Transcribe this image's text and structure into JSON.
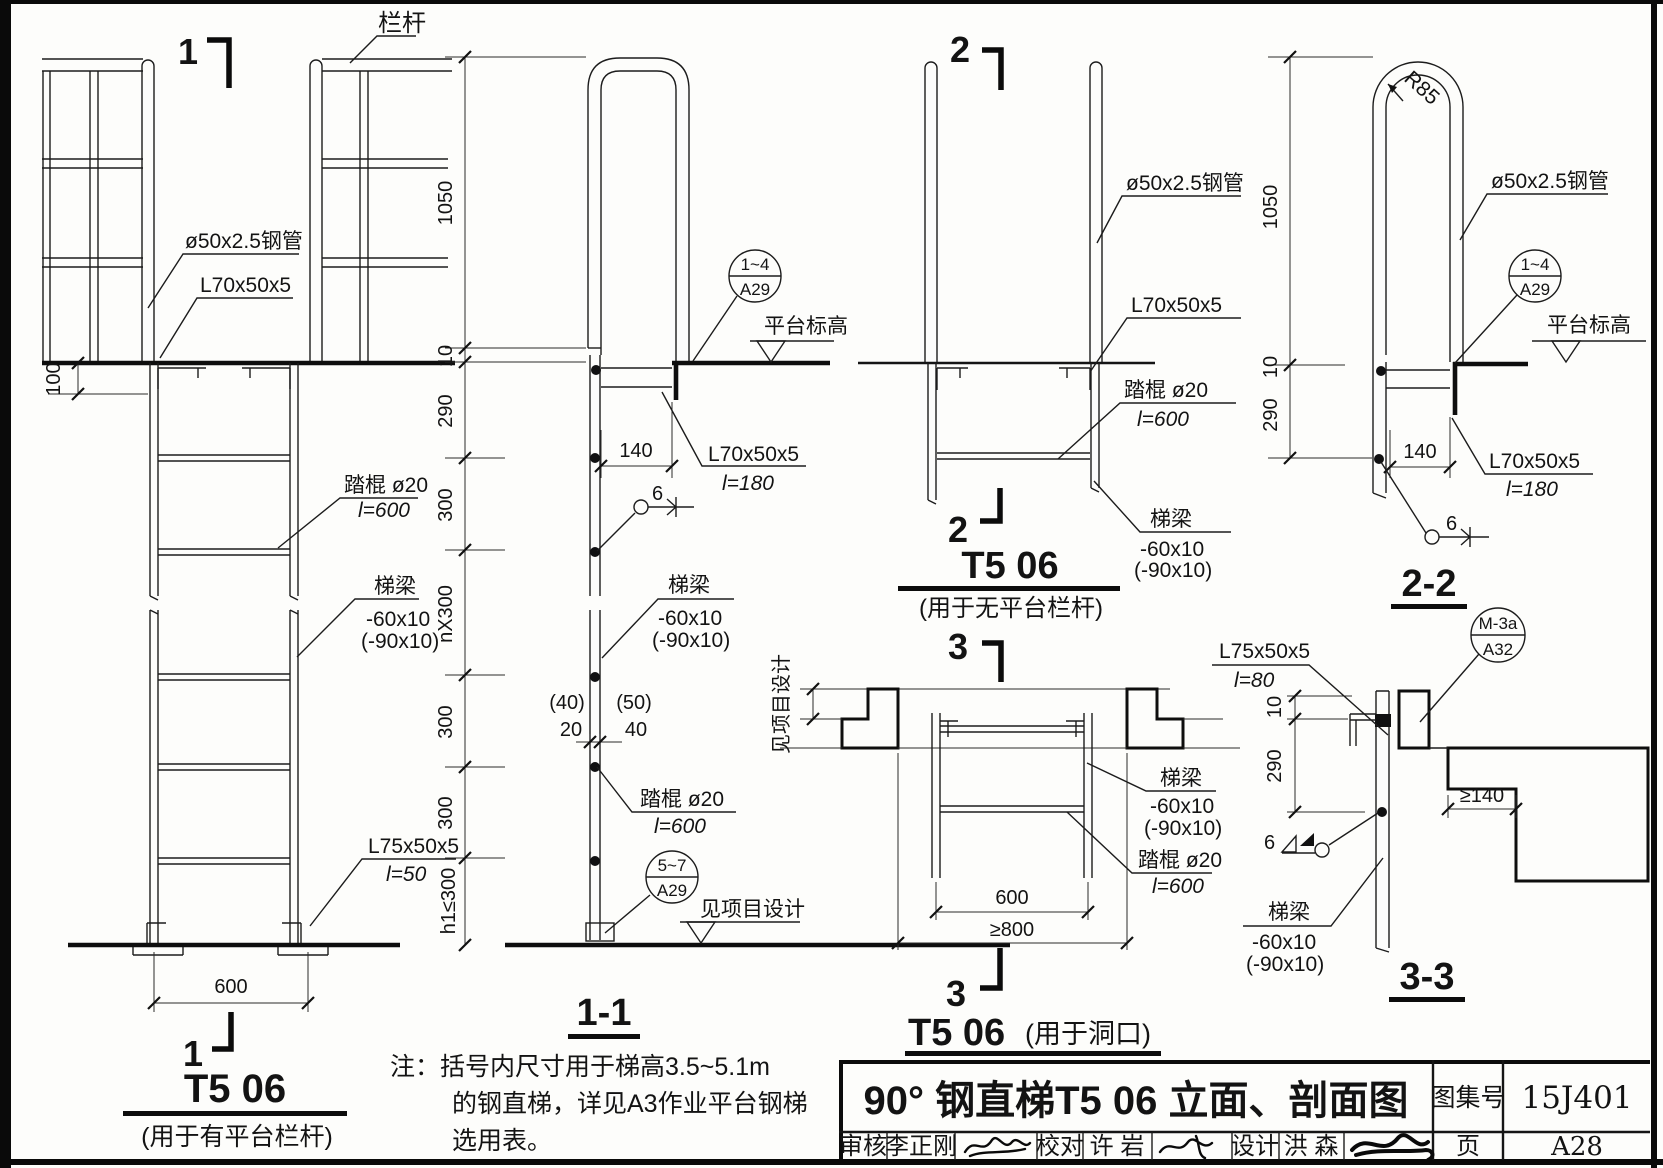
{
  "common": {
    "handrail": "栏杆",
    "pipe": "ø50x2.5钢管",
    "angle70": "L70x50x5",
    "angle70_len": "l=180",
    "rung": "踏棍 ø20",
    "rung_len": "l=600",
    "beam": "梯梁",
    "beam_size": "-60x10",
    "beam_size_alt": "(-90x10)",
    "angle75": "L75x50x5",
    "angle75_len": "l=50",
    "angle75_clip_len": "l=80",
    "platform_level": "平台标高",
    "project_design": "见项目设计",
    "weld_size": "6",
    "radius": "R85"
  },
  "dims": {
    "d100": "100",
    "d600": "600",
    "d1050": "1050",
    "d10": "10",
    "d290": "290",
    "d300a": "300",
    "dn300": "nX300",
    "d300b": "300",
    "d300c": "300",
    "h1": "h1≤300",
    "d140": "140",
    "p40": "(40)",
    "d20": "20",
    "p50": "(50)",
    "d40": "40",
    "ge800": "≥800",
    "ge140": "≥140"
  },
  "callouts": {
    "c14a29": {
      "top": "1~4",
      "bot": "A29"
    },
    "c57a29": {
      "top": "5~7",
      "bot": "A29"
    },
    "cm3a32": {
      "top": "M-3a",
      "bot": "A32"
    }
  },
  "sections": {
    "s1": {
      "marker": "1",
      "title": "T5 06",
      "subtitle": "(用于有平台栏杆)"
    },
    "s11": {
      "title": "1-1"
    },
    "s2": {
      "marker": "2",
      "title": "T5 06",
      "subtitle": "(用于无平台栏杆)"
    },
    "s22": {
      "title": "2-2"
    },
    "s3": {
      "marker": "3",
      "title": "T5 06",
      "subtitle": "(用于洞口)"
    },
    "s33": {
      "title": "3-3"
    }
  },
  "note": {
    "l1": "注：括号内尺寸用于梯高3.5~5.1m",
    "l2": "的钢直梯，详见A3作业平台钢梯",
    "l3": "选用表。"
  },
  "titleblock": {
    "main_title": "90° 钢直梯T5 06 立面、剖面图",
    "atlas_label": "图集号",
    "atlas_no": "15J401",
    "page_label": "页",
    "page_no": "A28",
    "audit_label": "审核",
    "audit_name": "李正刚",
    "proof_label": "校对",
    "proof_name": "许  岩",
    "design_label": "设计",
    "design_name": "洪  森"
  }
}
